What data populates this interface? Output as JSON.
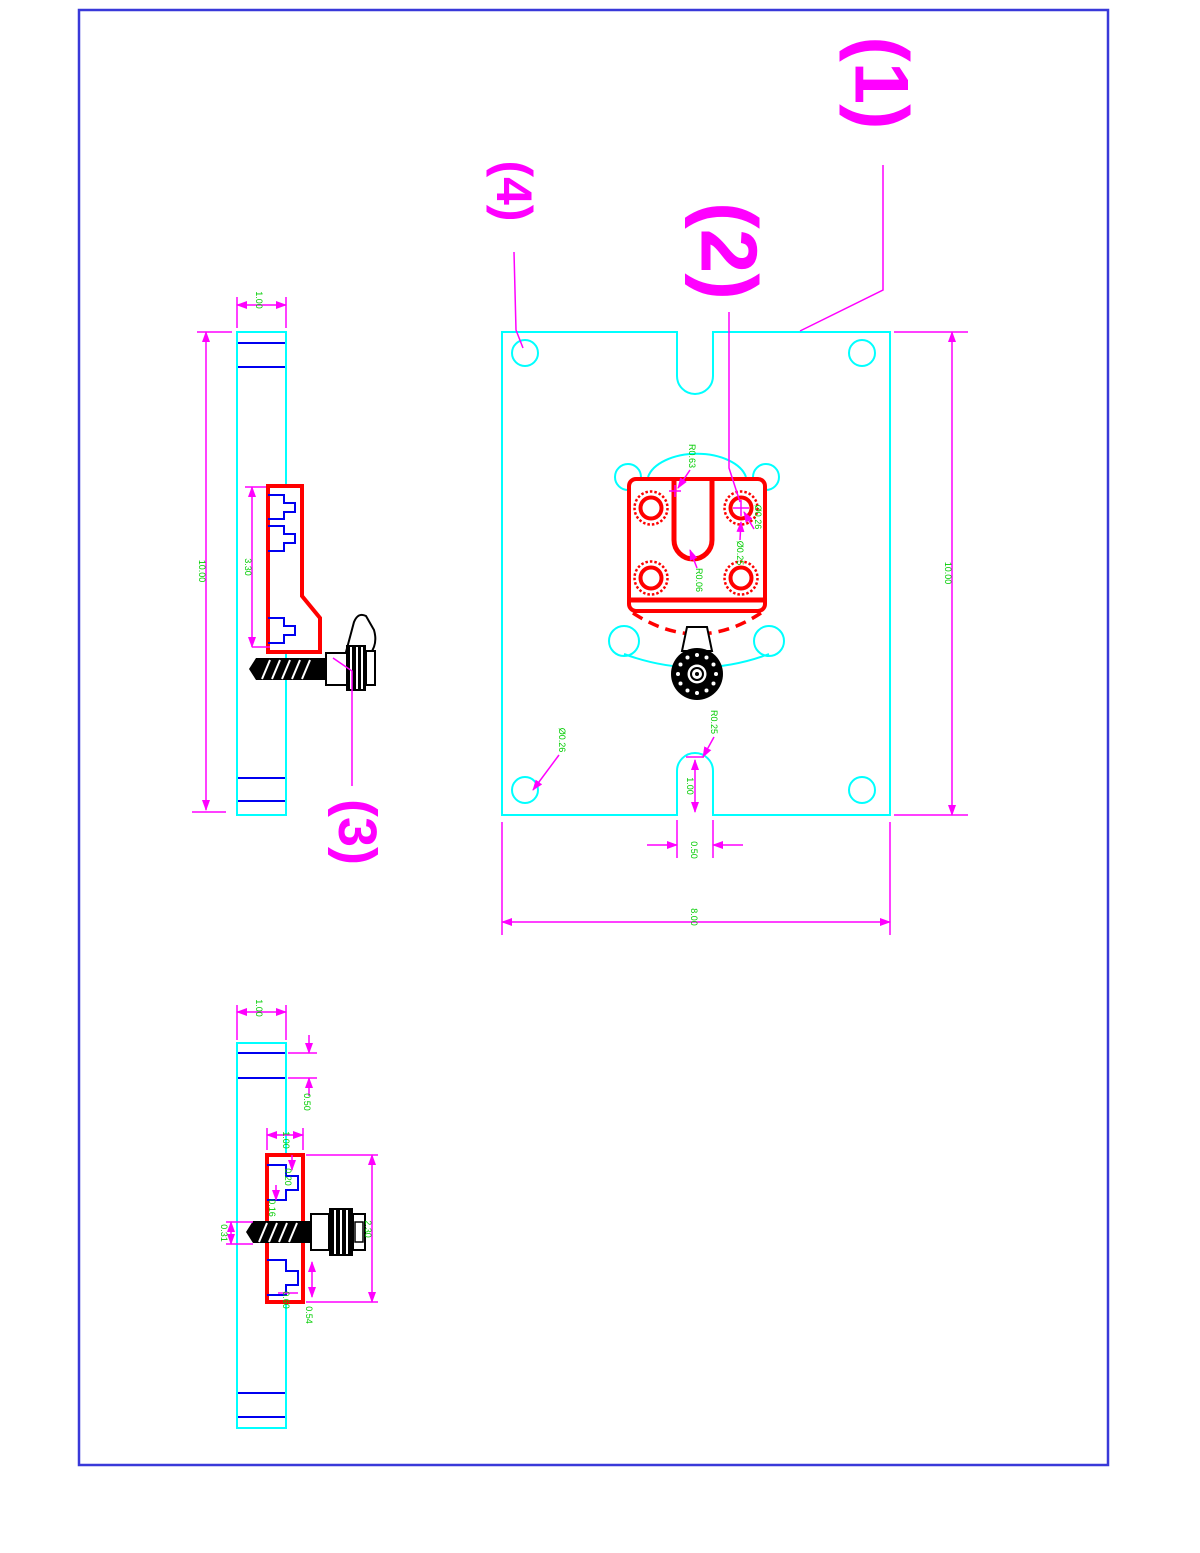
{
  "page": {
    "background": "#ffffff"
  },
  "colors": {
    "frame": "#3939d9",
    "plate_outline": "#00ffff",
    "part_outline": "#ff0000",
    "detail_lines": "#0000f0",
    "dim_lines": "#ff00ff",
    "dim_text": "#00cc00",
    "hardware": "#000000"
  },
  "callouts": {
    "item1": "(1)",
    "item2": "(2)",
    "item3": "(3)",
    "item4": "(4)"
  },
  "main_view": {
    "dims": {
      "height": "10.00",
      "width": "8.00",
      "slot_width": "0.50",
      "slot_height": "1.00",
      "slot_radius": "R0.25",
      "corner_hole_dia": "Ø0.26",
      "arc_radius": "R0.63",
      "pad_hole_dia": "Ø0.26",
      "pad_hole_dia2": "Ø0.25",
      "uslot_radius": "R0.06"
    }
  },
  "side_view": {
    "dims": {
      "thickness": "1.00",
      "height": "10.00",
      "bracket_span": "3.30"
    }
  },
  "section_view": {
    "dims": {
      "thickness": "1.00",
      "groove_offset": "0.50",
      "bracket_width": "1.00",
      "step_a": "0.20",
      "step_b": "0.16",
      "bracket_height": "2.30",
      "slot_depth": "0.60",
      "slot_width": "0.54",
      "screw_dia": "0.31"
    }
  }
}
